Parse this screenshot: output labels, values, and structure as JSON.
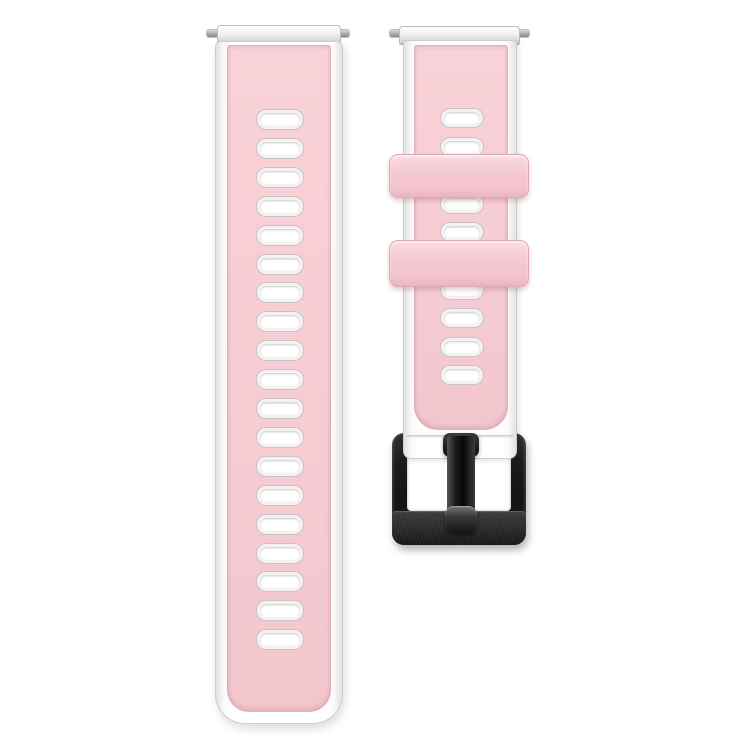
{
  "scene": {
    "description": "Product photo of a two-piece silicone smartwatch band: pink top layer over a white base with rows of rectangular vent holes, two pink keeper loops, silver spring-bar end caps, and a brushed black pin buckle on a plain white background",
    "background_color": "#ffffff"
  },
  "colors": {
    "strap_pink": "#f7cdd4",
    "strap_pink_light": "#f9d2d8",
    "strap_pink_deep": "#f3c6ce",
    "keeper_pink": "#f6cbd3",
    "base_white": "#ffffff",
    "edge_gray": "#cccccc",
    "cap_silver": "#e8e8e8",
    "pin_gray": "#9a9a9a",
    "buckle_black": "#1a1a1c",
    "buckle_brushed": "#2c2c2e",
    "hole_fill": "#ffffff",
    "hole_rim": "#c9c2c3"
  },
  "left_strap": {
    "part": "long tail half",
    "holes": {
      "count": 19,
      "start_top": 64,
      "spacing": 28.9,
      "item_name": "vent-hole"
    }
  },
  "right_strap": {
    "part": "buckle half",
    "holes": {
      "count": 10,
      "start_top": 63,
      "spacing": 28.6,
      "item_name": "vent-hole"
    },
    "keeper_count": 2,
    "buckle": {
      "type": "pin buckle",
      "finish": "brushed black metal"
    }
  }
}
